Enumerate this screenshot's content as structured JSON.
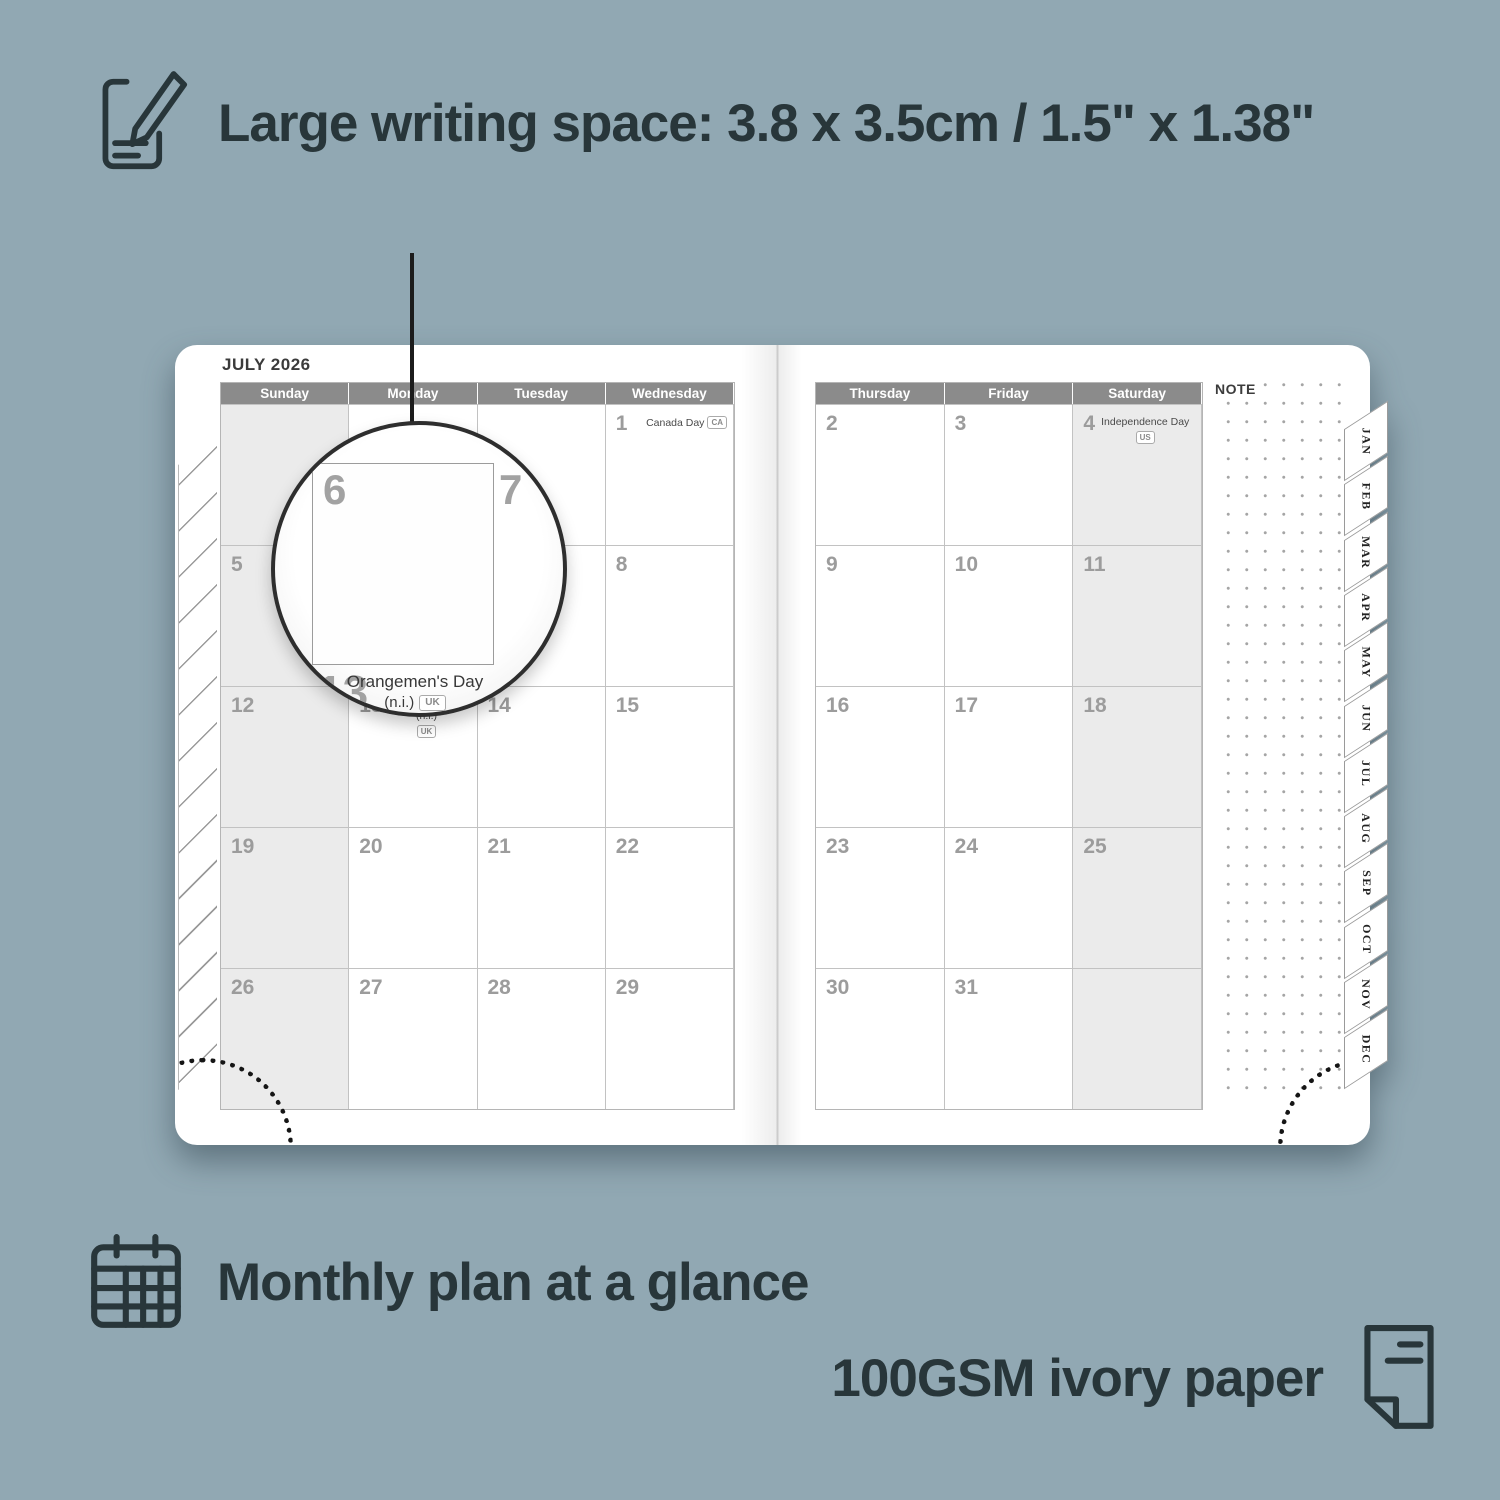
{
  "image_type": "planner-product-feature-graphic",
  "colors": {
    "background": "#91a8b3",
    "text": "#28363a",
    "header_bar": "#8b8b8b",
    "weekend_fill": "#ebebeb",
    "page": "#ffffff",
    "grid_line": "#c2c2c2",
    "date_number": "#9c9c9c"
  },
  "features": {
    "writing_space": {
      "icon": "notebook-pencil-icon",
      "label": "Large writing space: 3.8 x 3.5cm / 1.5\" x 1.38\""
    },
    "monthly_plan": {
      "icon": "calendar-grid-icon",
      "label": "Monthly plan at a glance"
    },
    "paper": {
      "icon": "paper-icon",
      "label": "100GSM ivory paper"
    }
  },
  "planner": {
    "month_title": "JULY 2026",
    "note_label": "NOTE",
    "left_page": {
      "day_headers": [
        "Sunday",
        "Monday",
        "Tuesday",
        "Wednesday"
      ],
      "weeks": [
        [
          "",
          "",
          "",
          "1"
        ],
        [
          "5",
          "6",
          "7",
          "8"
        ],
        [
          "12",
          "13",
          "14",
          "15"
        ],
        [
          "19",
          "20",
          "21",
          "22"
        ],
        [
          "26",
          "27",
          "28",
          "29"
        ]
      ]
    },
    "right_page": {
      "day_headers": [
        "Thursday",
        "Friday",
        "Saturday"
      ],
      "weeks": [
        [
          "2",
          "3",
          "4"
        ],
        [
          "9",
          "10",
          "11"
        ],
        [
          "16",
          "17",
          "18"
        ],
        [
          "23",
          "24",
          "25"
        ],
        [
          "30",
          "31",
          ""
        ]
      ]
    },
    "holidays": {
      "1": {
        "name": "Canada Day",
        "badge": "CA"
      },
      "4": {
        "name": "Independence Day",
        "badge": "US"
      },
      "13": {
        "name": "Orangemen's Day (n.i.)",
        "badge": "UK"
      }
    },
    "month_tabs": [
      "JAN",
      "FEB",
      "MAR",
      "APR",
      "MAY",
      "JUN",
      "JUL",
      "AUG",
      "SEP",
      "OCT",
      "NOV",
      "DEC"
    ],
    "magnifier": {
      "day_top_left": "6",
      "day_right": "7",
      "day_bottom": "13",
      "holiday_line1": "Orangemen's Day",
      "holiday_line2": "(n.i.)",
      "holiday_badge": "UK"
    }
  }
}
